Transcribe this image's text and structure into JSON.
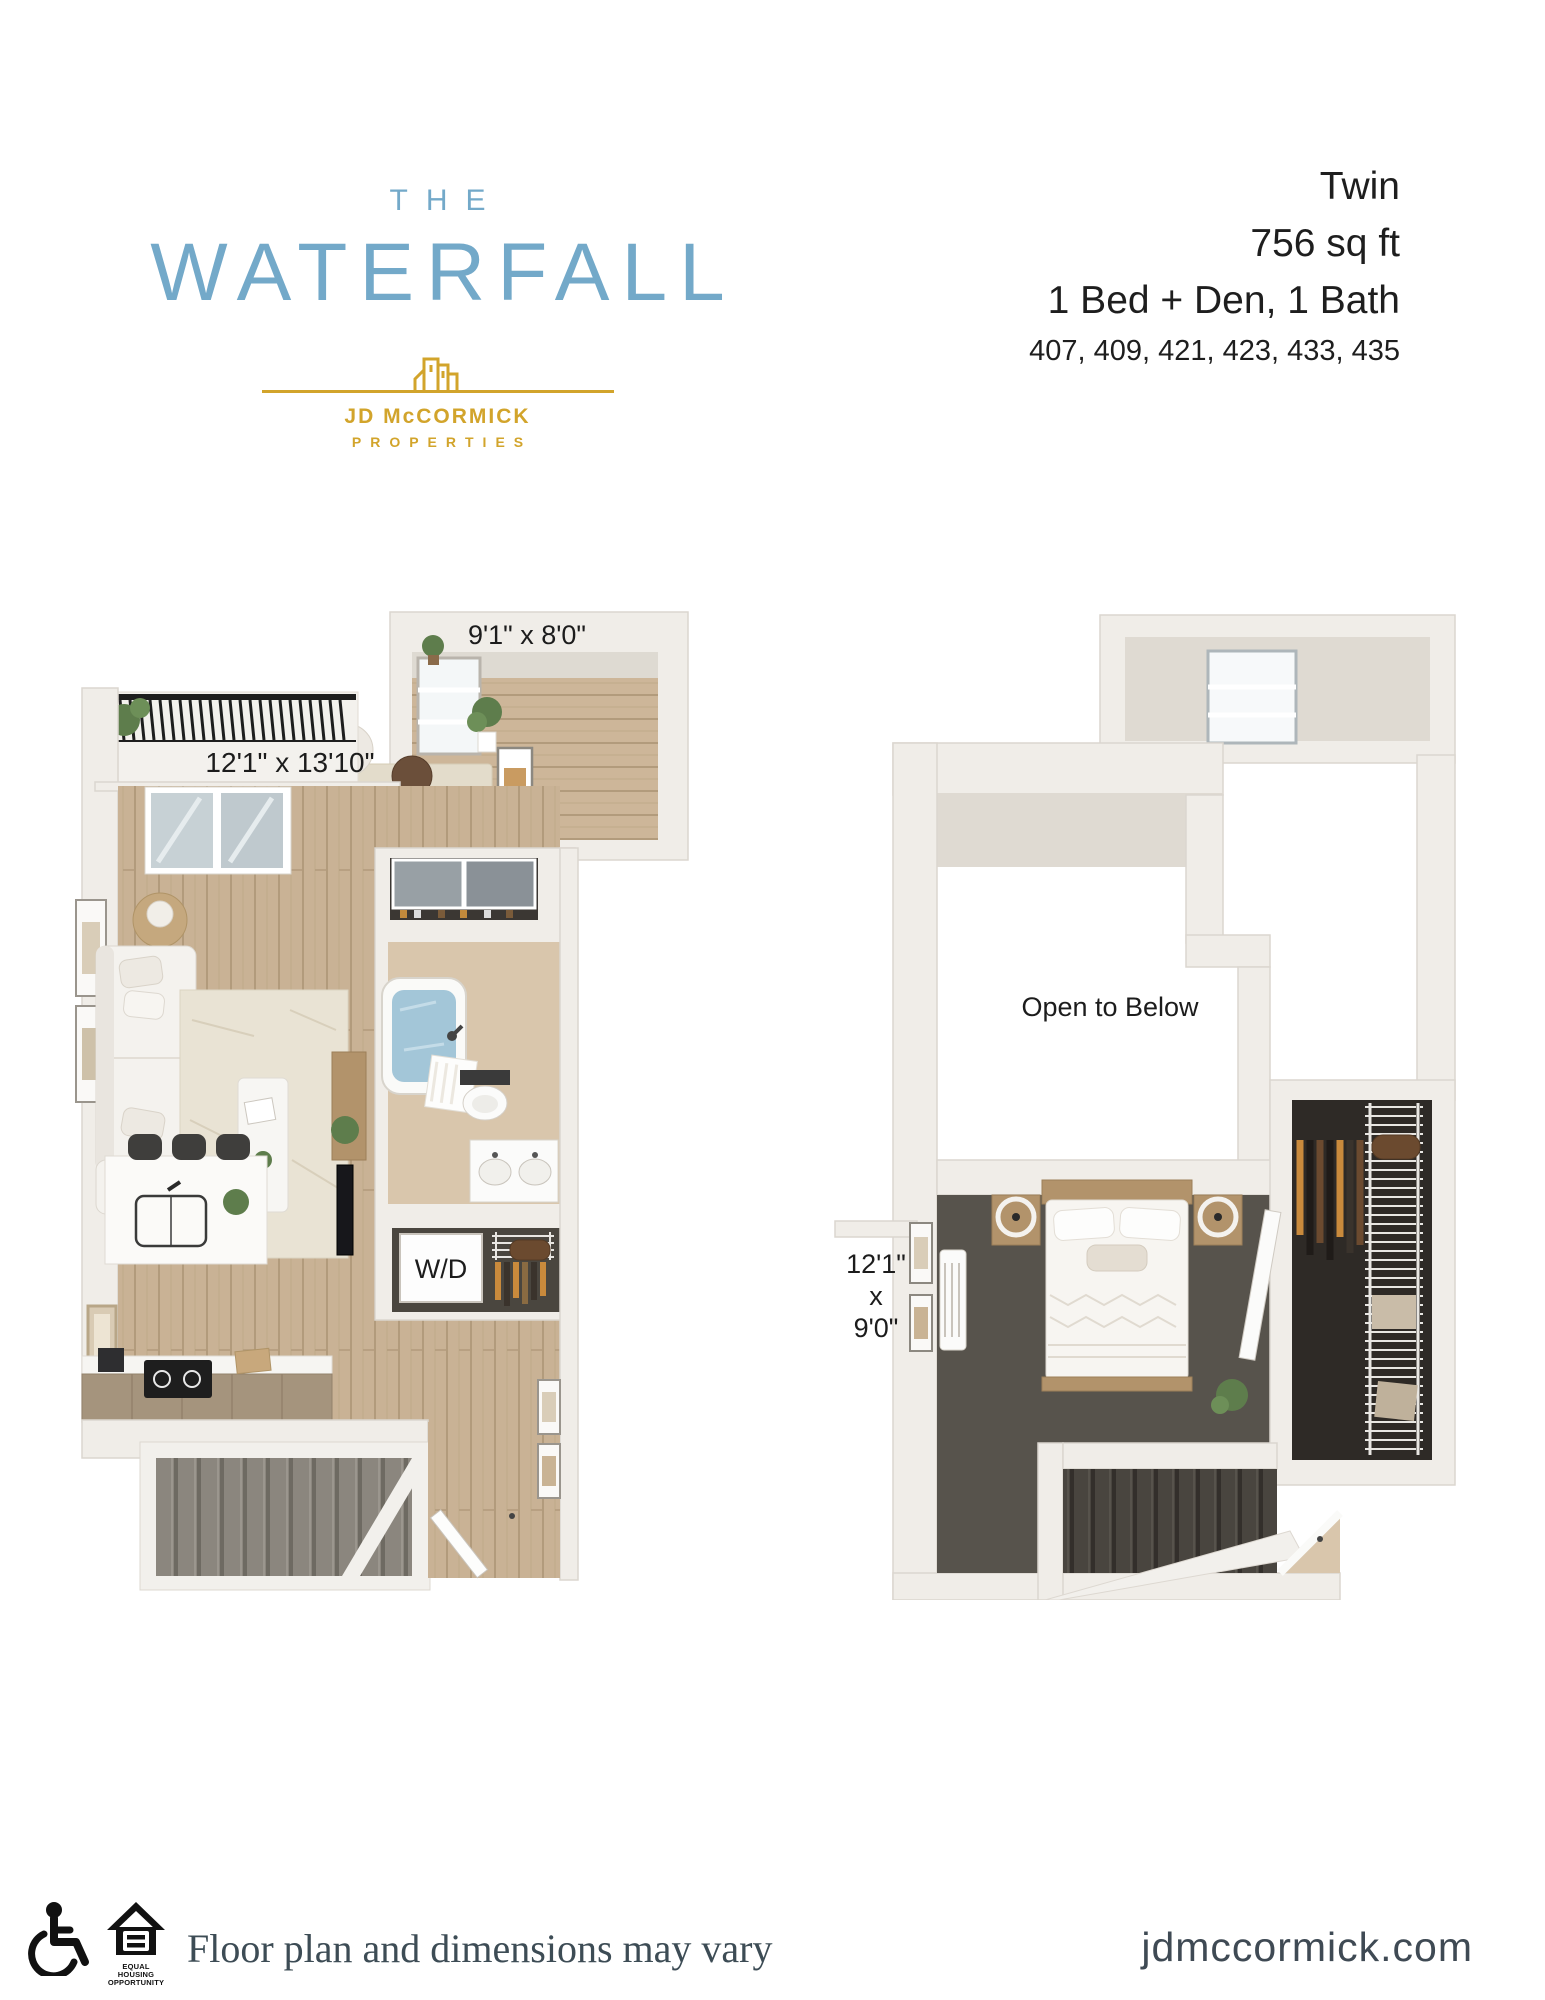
{
  "brand": {
    "the": "THE",
    "name": "WATERFALL",
    "company": "JD McCORMICK",
    "company_sub": "PROPERTIES",
    "blue": "#73A9C9",
    "gold": "#D2A42B"
  },
  "unit": {
    "name": "Twin",
    "area": "756 sq ft",
    "layout": "1 Bed + Den, 1 Bath",
    "unit_numbers": "407, 409, 421, 423, 433, 435"
  },
  "floor_plan_1": {
    "den_dimensions": "9'1\" x 8'0\"",
    "living_dimensions": "12'1\" x 13'10\"",
    "washer_dryer": "W/D"
  },
  "floor_plan_2": {
    "open_label": "Open to Below",
    "dimensions_line1": "12'1\"",
    "dimensions_line2": "x",
    "dimensions_line3": "9'0\""
  },
  "footer": {
    "disclaimer": "Floor plan and dimensions may vary",
    "website": "jdmccormick.com",
    "eho_line1": "EQUAL HOUSING",
    "eho_line2": "OPPORTUNITY"
  }
}
